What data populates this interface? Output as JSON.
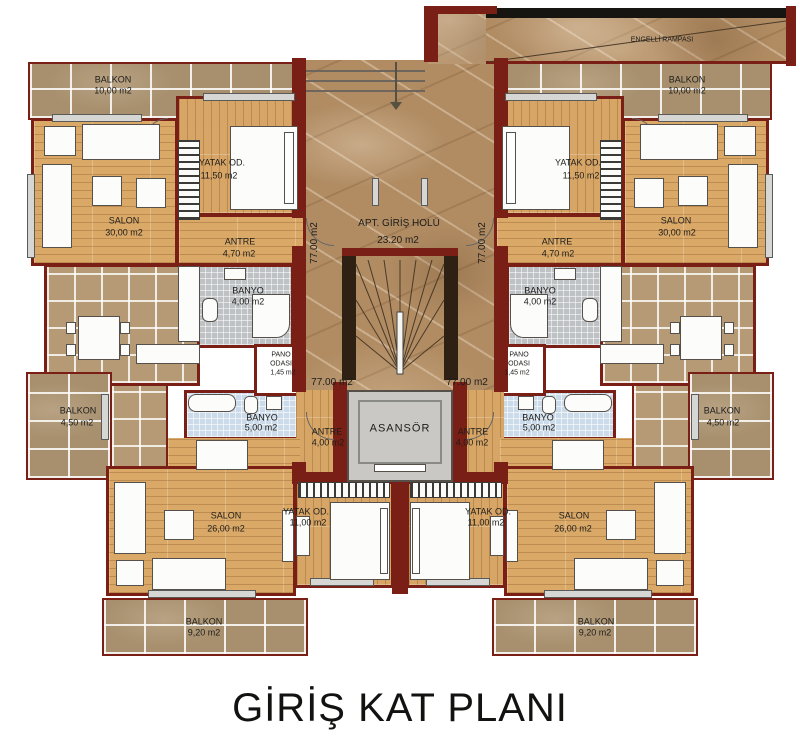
{
  "title": "GİRİŞ KAT PLANI",
  "center": {
    "hall_name": "APT. GİRİŞ HOLÜ",
    "hall_area": "23.20 m2",
    "floor_area": "77.00 m2",
    "elevator_label": "ASANSÖR",
    "ramp_label": "ENGELLİ RAMPASI"
  },
  "colors": {
    "wall": "#7a1f15",
    "wood_floor": "#daa968",
    "balcony_tile": "#a8906e",
    "kitchen_tile": "#b59a75",
    "marble": "#b18c63",
    "bath_gray": "#bfc2c4",
    "bath_blue": "#ccdbe9",
    "elevator_gray": "#c9c8c4"
  },
  "units": {
    "top_left": {
      "balkon_name": "BALKON",
      "balkon_area": "10,00 m2",
      "salon_name": "SALON",
      "salon_area": "30,00 m2",
      "yatak_name": "YATAK OD.",
      "yatak_area": "11,50 m2",
      "antre_name": "ANTRE",
      "antre_area": "4,70 m2",
      "banyo_name": "BANYO",
      "banyo_area": "4,00 m2"
    },
    "top_right": {
      "balkon_name": "BALKON",
      "balkon_area": "10,00 m2",
      "salon_name": "SALON",
      "salon_area": "30,00 m2",
      "yatak_name": "YATAK OD.",
      "yatak_area": "11,50 m2",
      "antre_name": "ANTRE",
      "antre_area": "4,70 m2",
      "banyo_name": "BANYO",
      "banyo_area": "4,00 m2"
    },
    "mid_left": {
      "balkon_name": "BALKON",
      "balkon_area": "4,50 m2",
      "pano_line1": "PANO",
      "pano_line2": "ODASI",
      "pano_area": "1,45 m2",
      "banyo_name": "BANYO",
      "banyo_area": "5,00 m2",
      "antre_name": "ANTRE",
      "antre_area": "4,00 m2"
    },
    "mid_right": {
      "balkon_name": "BALKON",
      "balkon_area": "4,50 m2",
      "pano_line1": "PANO",
      "pano_line2": "ODASI",
      "pano_area": "1,45 m2",
      "banyo_name": "BANYO",
      "banyo_area": "5,00 m2",
      "antre_name": "ANTRE",
      "antre_area": "4,00 m2"
    },
    "bottom_left": {
      "salon_name": "SALON",
      "salon_area": "26,00 m2",
      "yatak_name": "YATAK OD.",
      "yatak_area": "11,00 m2",
      "balkon_name": "BALKON",
      "balkon_area": "9,20 m2"
    },
    "bottom_right": {
      "salon_name": "SALON",
      "salon_area": "26,00 m2",
      "yatak_name": "YATAK OD.",
      "yatak_area": "11,00 m2",
      "balkon_name": "BALKON",
      "balkon_area": "9,20 m2"
    }
  }
}
